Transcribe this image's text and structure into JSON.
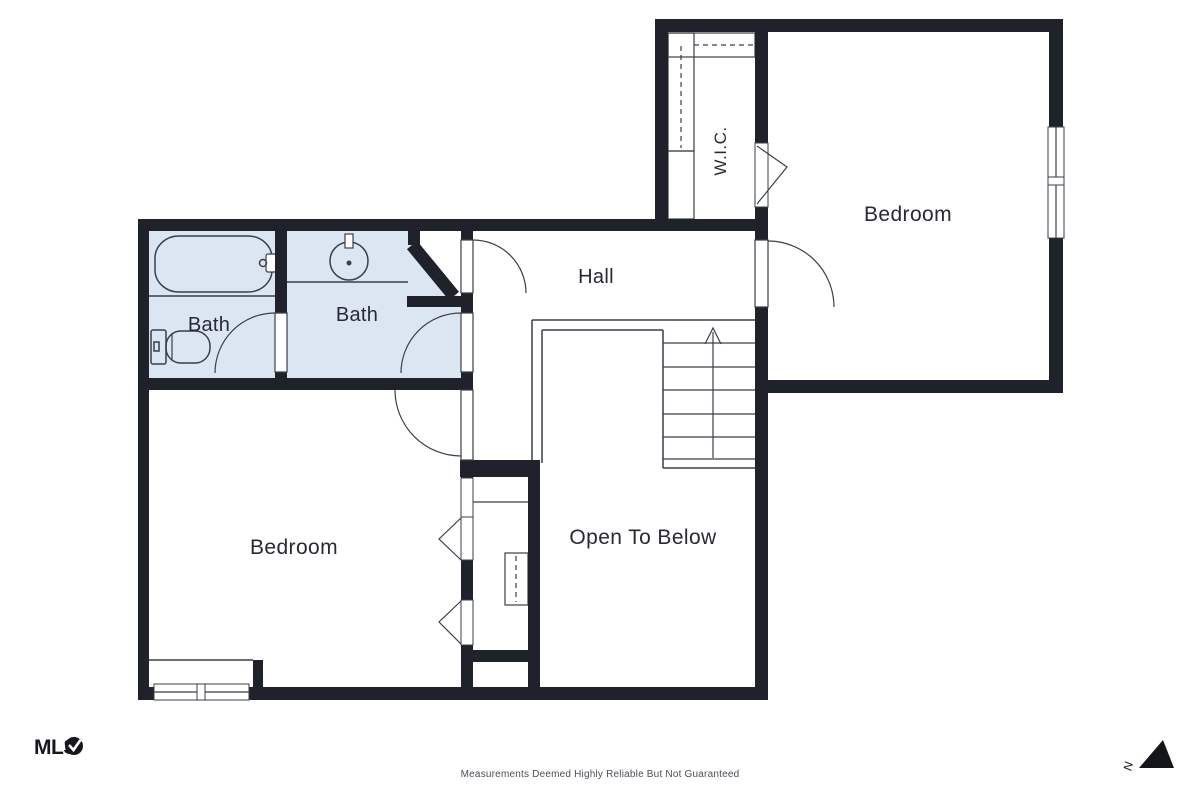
{
  "rooms": {
    "bedroom_upper": {
      "label": "Bedroom"
    },
    "bedroom_lower": {
      "label": "Bedroom"
    },
    "hall": {
      "label": "Hall"
    },
    "bath_left": {
      "label": "Bath"
    },
    "bath_right": {
      "label": "Bath"
    },
    "walk_in_closet": {
      "label": "W.I.C."
    },
    "open_to_below": {
      "label": "Open To Below"
    }
  },
  "branding": {
    "logo_text": "MLS"
  },
  "compass": {
    "north_label": "N"
  },
  "footer": {
    "disclaimer": "Measurements Deemed Highly Reliable But Not Guaranteed"
  },
  "colors": {
    "wall": "#1f222a",
    "bath_fill": "#dce6f3",
    "thin_line": "#3a3f48",
    "text": "#272a31",
    "muted_text": "#4a4e57"
  }
}
